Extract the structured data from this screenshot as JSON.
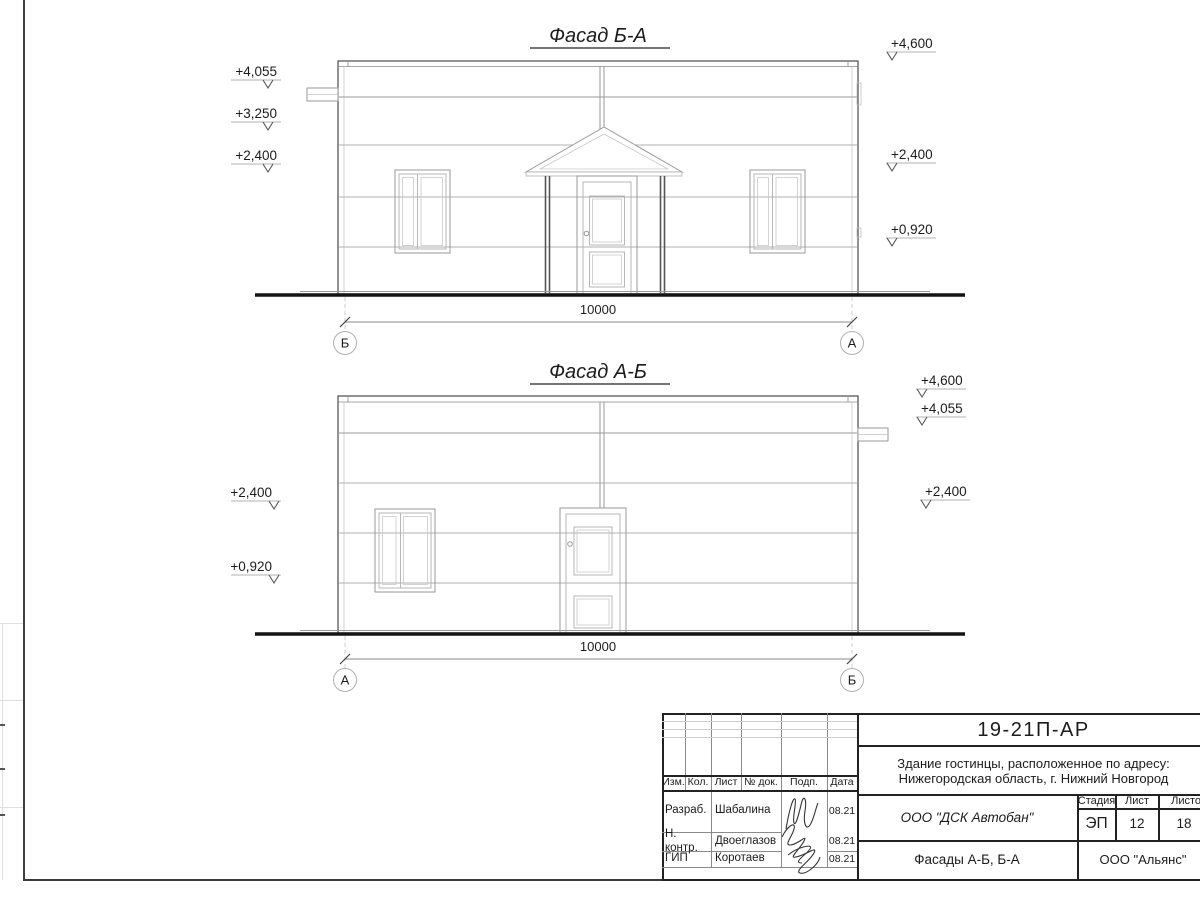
{
  "colors": {
    "main_line": "#4a4a4a",
    "light_line": "#b0b0b0",
    "ground_line": "#141414"
  },
  "facades": [
    {
      "title": "Фасад Б-А",
      "dim": "10000",
      "axis_left": "Б",
      "axis_right": "А",
      "elev_left": [
        "+4,055",
        "+3,250",
        "+2,400"
      ],
      "elev_right": [
        "+4,600",
        "+2,400",
        "+0,920"
      ]
    },
    {
      "title": "Фасад А-Б",
      "dim": "10000",
      "axis_left": "А",
      "axis_right": "Б",
      "elev_left": [
        "+2,400",
        "+0,920"
      ],
      "elev_right": [
        "+4,600",
        "+4,055",
        "+2,400"
      ]
    }
  ],
  "titleblock": {
    "doc_number": "19-21П-АР",
    "project_line1": "Здание гостинцы, расположенное по адресу:",
    "project_line2": "Нижегородская область, г. Нижний Новгород",
    "cols": [
      "Изм.",
      "Кол.",
      "Лист",
      "№ док.",
      "Подп.",
      "Дата"
    ],
    "rows": [
      {
        "role": "Разраб.",
        "name": "Шабалина",
        "date": "08.21"
      },
      {
        "role": "Н. контр.",
        "name": "Двоеглазов",
        "date": "08.21"
      },
      {
        "role": "ГИП",
        "name": "Коротаев",
        "date": "08.21"
      }
    ],
    "company": "ООО \"ДСК Автобан\"",
    "stage_label": "Стадия",
    "sheet_label": "Лист",
    "sheets_label": "Листов",
    "stage": "ЭП",
    "sheet_num": "12",
    "sheets_total": "18",
    "drawing_title": "Фасады А-Б, Б-А",
    "org": "ООО \"Альянс\""
  }
}
